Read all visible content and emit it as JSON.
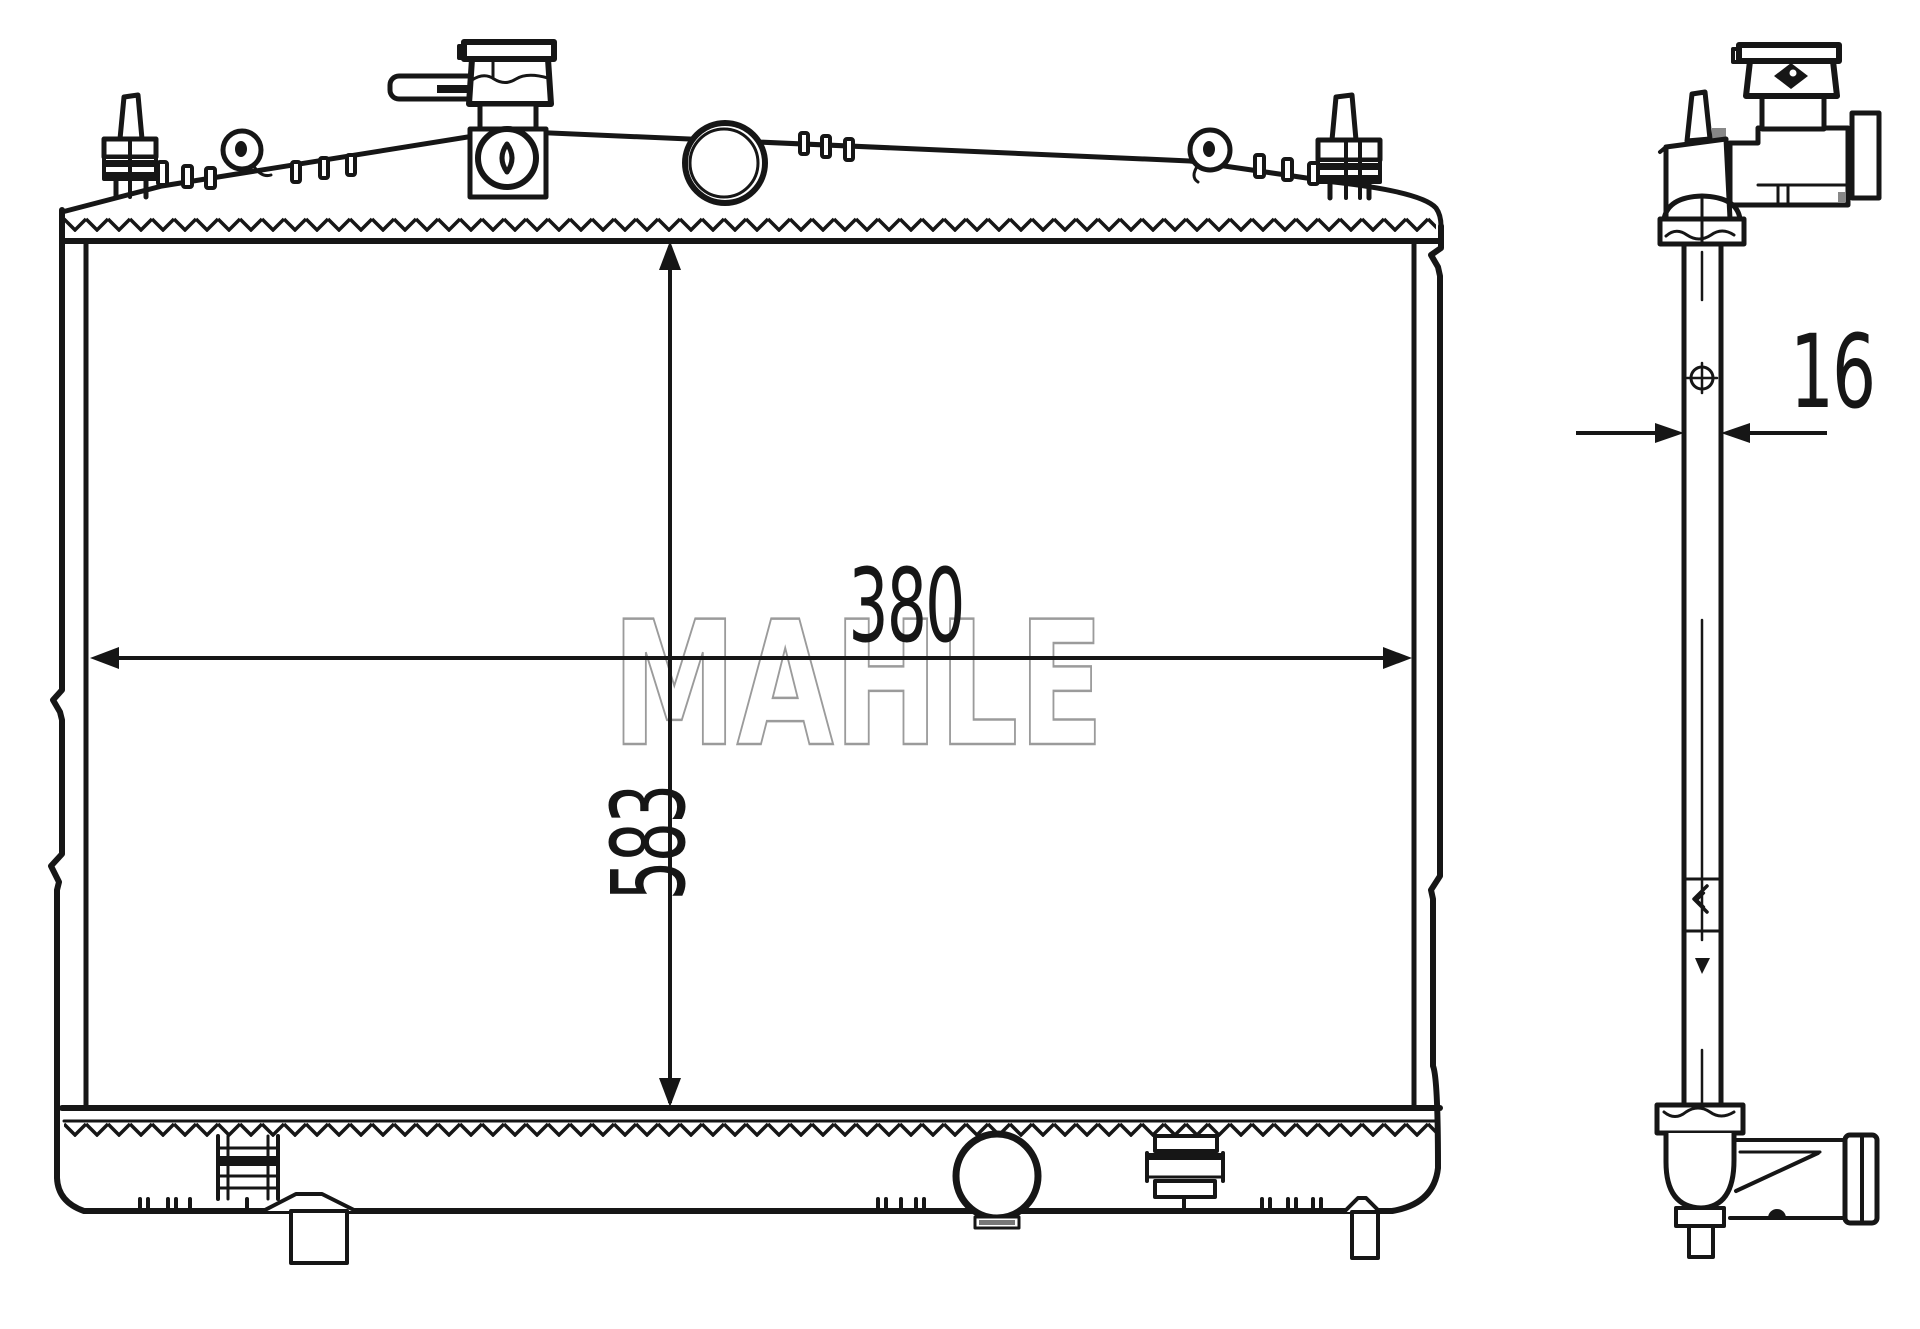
{
  "watermark": {
    "text": "MAHLE"
  },
  "dimensions": {
    "width": "380",
    "height": "583",
    "depth": "16"
  },
  "colors": {
    "ink": "#161616",
    "watermark": "#9b9b9b",
    "background": "#ffffff"
  }
}
